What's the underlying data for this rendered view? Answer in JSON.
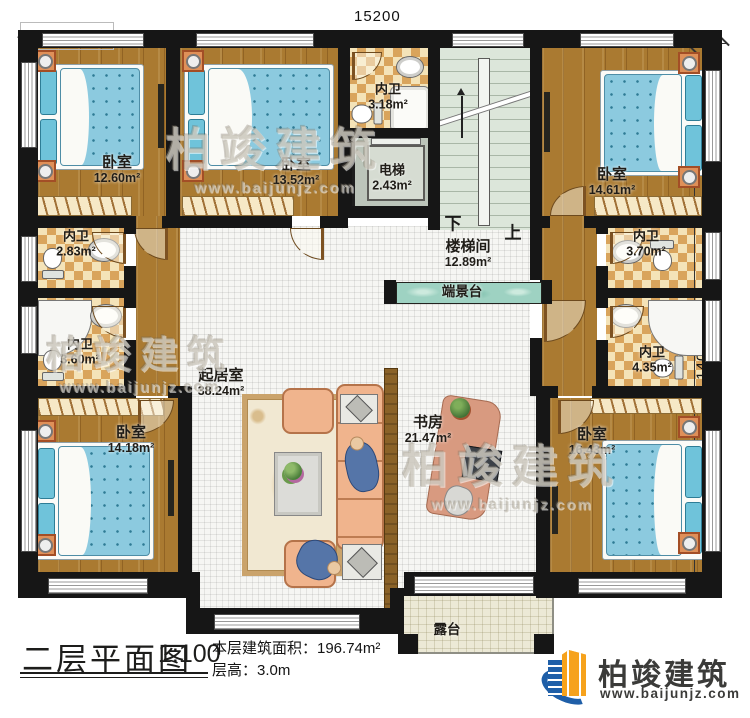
{
  "dimensions": {
    "top": "15200",
    "right": "14000"
  },
  "rooms": {
    "bedroom_top_left": {
      "name": "卧室",
      "area": "12.60m²"
    },
    "bedroom_top_mid": {
      "name": "卧室",
      "area": "13.52m²"
    },
    "bath_top": {
      "name": "内卫",
      "area": "3.18m²"
    },
    "elevator": {
      "name": "电梯",
      "area": "2.43m²"
    },
    "stairwell": {
      "name": "楼梯间",
      "area": "12.89m²"
    },
    "bedroom_top_right": {
      "name": "卧室",
      "area": "14.61m²"
    },
    "bath_left_upper": {
      "name": "内卫",
      "area": "2.83m²"
    },
    "bath_left_lower": {
      "name": "内卫",
      "area": "3.60m²"
    },
    "bath_right_upper": {
      "name": "内卫",
      "area": "3.70m²"
    },
    "bath_right_lower": {
      "name": "内卫",
      "area": "4.35m²"
    },
    "living_room": {
      "name": "起居室",
      "area": "38.24m²"
    },
    "study": {
      "name": "书房",
      "area": "21.47m²"
    },
    "bedroom_bottom_left": {
      "name": "卧室",
      "area": "14.18m²"
    },
    "bedroom_bottom_right": {
      "name": "卧室",
      "area": "16.43m²"
    },
    "console_table": {
      "name": "端景台"
    },
    "terrace": {
      "name": "露台"
    }
  },
  "stairs": {
    "down_label": "下",
    "up_label": "上"
  },
  "title_block": {
    "title": "二层平面图",
    "scale": "1:100",
    "floor_area": "本层建筑面积：196.74m²",
    "floor_height": "层高：3.0m"
  },
  "logo": {
    "company": "柏竣建筑",
    "website": "www.baijunjz.com"
  },
  "watermark": {
    "brand": "柏竣建筑",
    "website": "www.baijunjz.com"
  },
  "colors": {
    "wall": "#161616",
    "wood_floor": "#aa7a31",
    "bath_tile": "#d9a45c",
    "stair": "#dce6da",
    "console": "#9ed2c2",
    "terrace": "#ece9d6",
    "logo_blue": "#1f5fa8",
    "logo_orange": "#f6a21c"
  }
}
